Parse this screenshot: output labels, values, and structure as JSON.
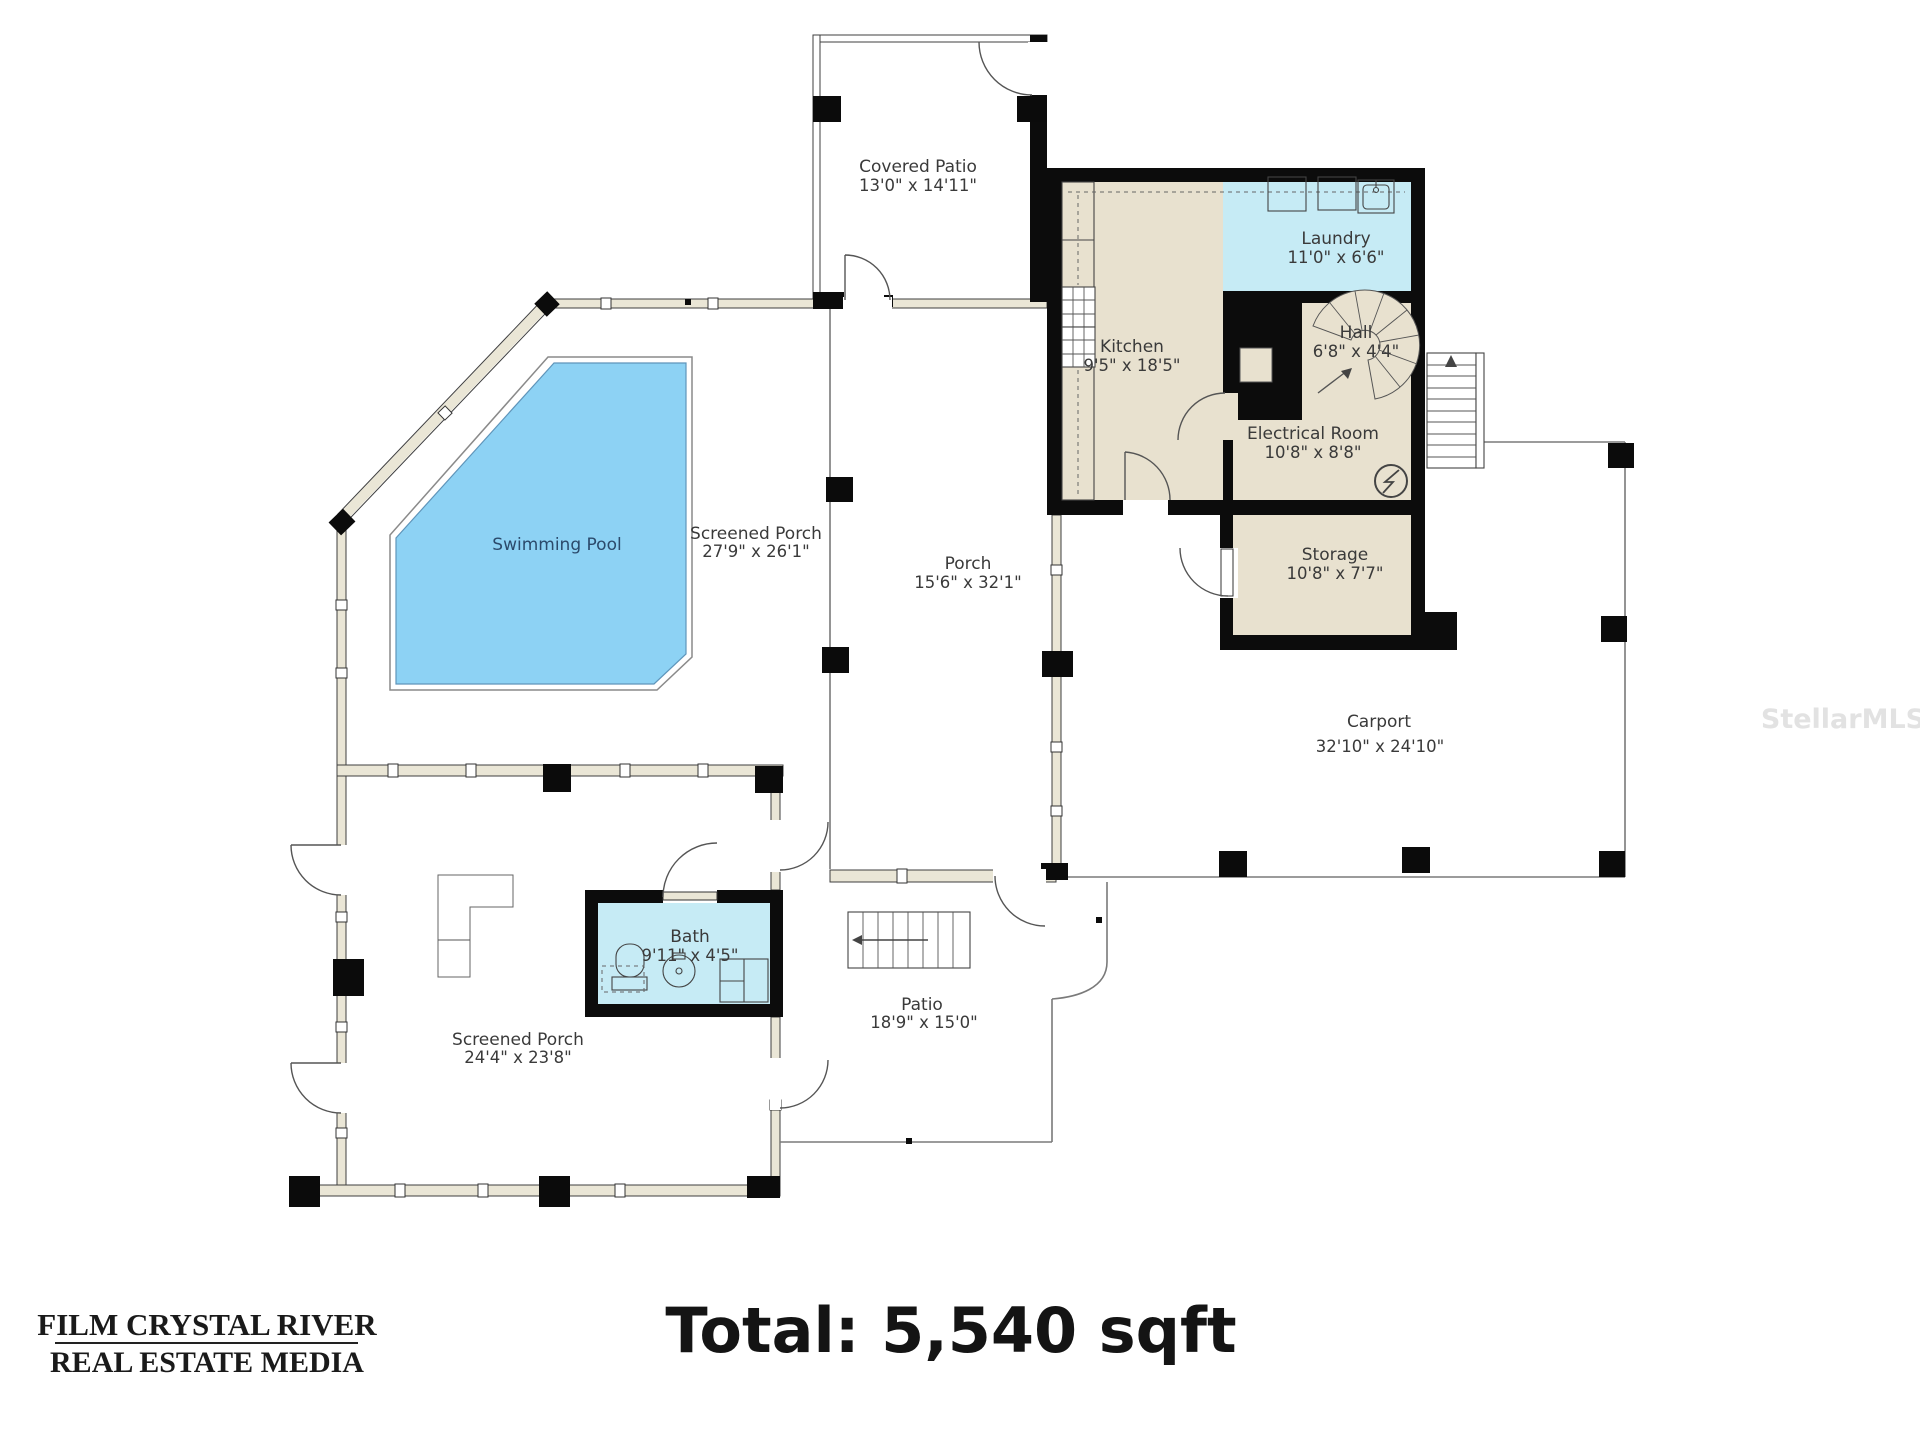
{
  "rooms": {
    "covered_patio": {
      "name": "Covered Patio",
      "dims": "13'0\" x 14'11\""
    },
    "laundry": {
      "name": "Laundry",
      "dims": "11'0\" x 6'6\""
    },
    "kitchen": {
      "name": "Kitchen",
      "dims": "9'5\" x 18'5\""
    },
    "hall": {
      "name": "Hall",
      "dims": "6'8\" x 4'4\""
    },
    "electrical": {
      "name": "Electrical Room",
      "dims": "10'8\" x 8'8\""
    },
    "storage": {
      "name": "Storage",
      "dims": "10'8\" x 7'7\""
    },
    "swimming_pool": {
      "name": "Swimming Pool"
    },
    "screened_porch_pool": {
      "name": "Screened Porch",
      "dims": "27'9\" x 26'1\""
    },
    "porch": {
      "name": "Porch",
      "dims": "15'6\" x 32'1\""
    },
    "carport": {
      "name": "Carport",
      "dims": "32'10\" x 24'10\""
    },
    "bath": {
      "name": "Bath",
      "dims": "9'11\" x 4'5\""
    },
    "screened_porch_lower": {
      "name": "Screened Porch",
      "dims": "24'4\" x 23'8\""
    },
    "patio": {
      "name": "Patio",
      "dims": "18'9\" x 15'0\""
    }
  },
  "footer": {
    "total": "Total: 5,540 sqft"
  },
  "branding": {
    "logo_line1": "FILM CRYSTAL RIVER",
    "logo_line2": "REAL ESTATE MEDIA"
  },
  "watermark": "StellarMLS",
  "colors": {
    "room_fill": "#e8e1cf",
    "wet_room_fill": "#c6ebf5",
    "pool_fill": "#8dd2f4",
    "wall": "#0c0c0c",
    "screen_wall_fill": "#eae6d6",
    "boundary_line": "#7a7a7a",
    "label_text": "#3a3a3a",
    "pool_text": "#2b4a6b"
  }
}
